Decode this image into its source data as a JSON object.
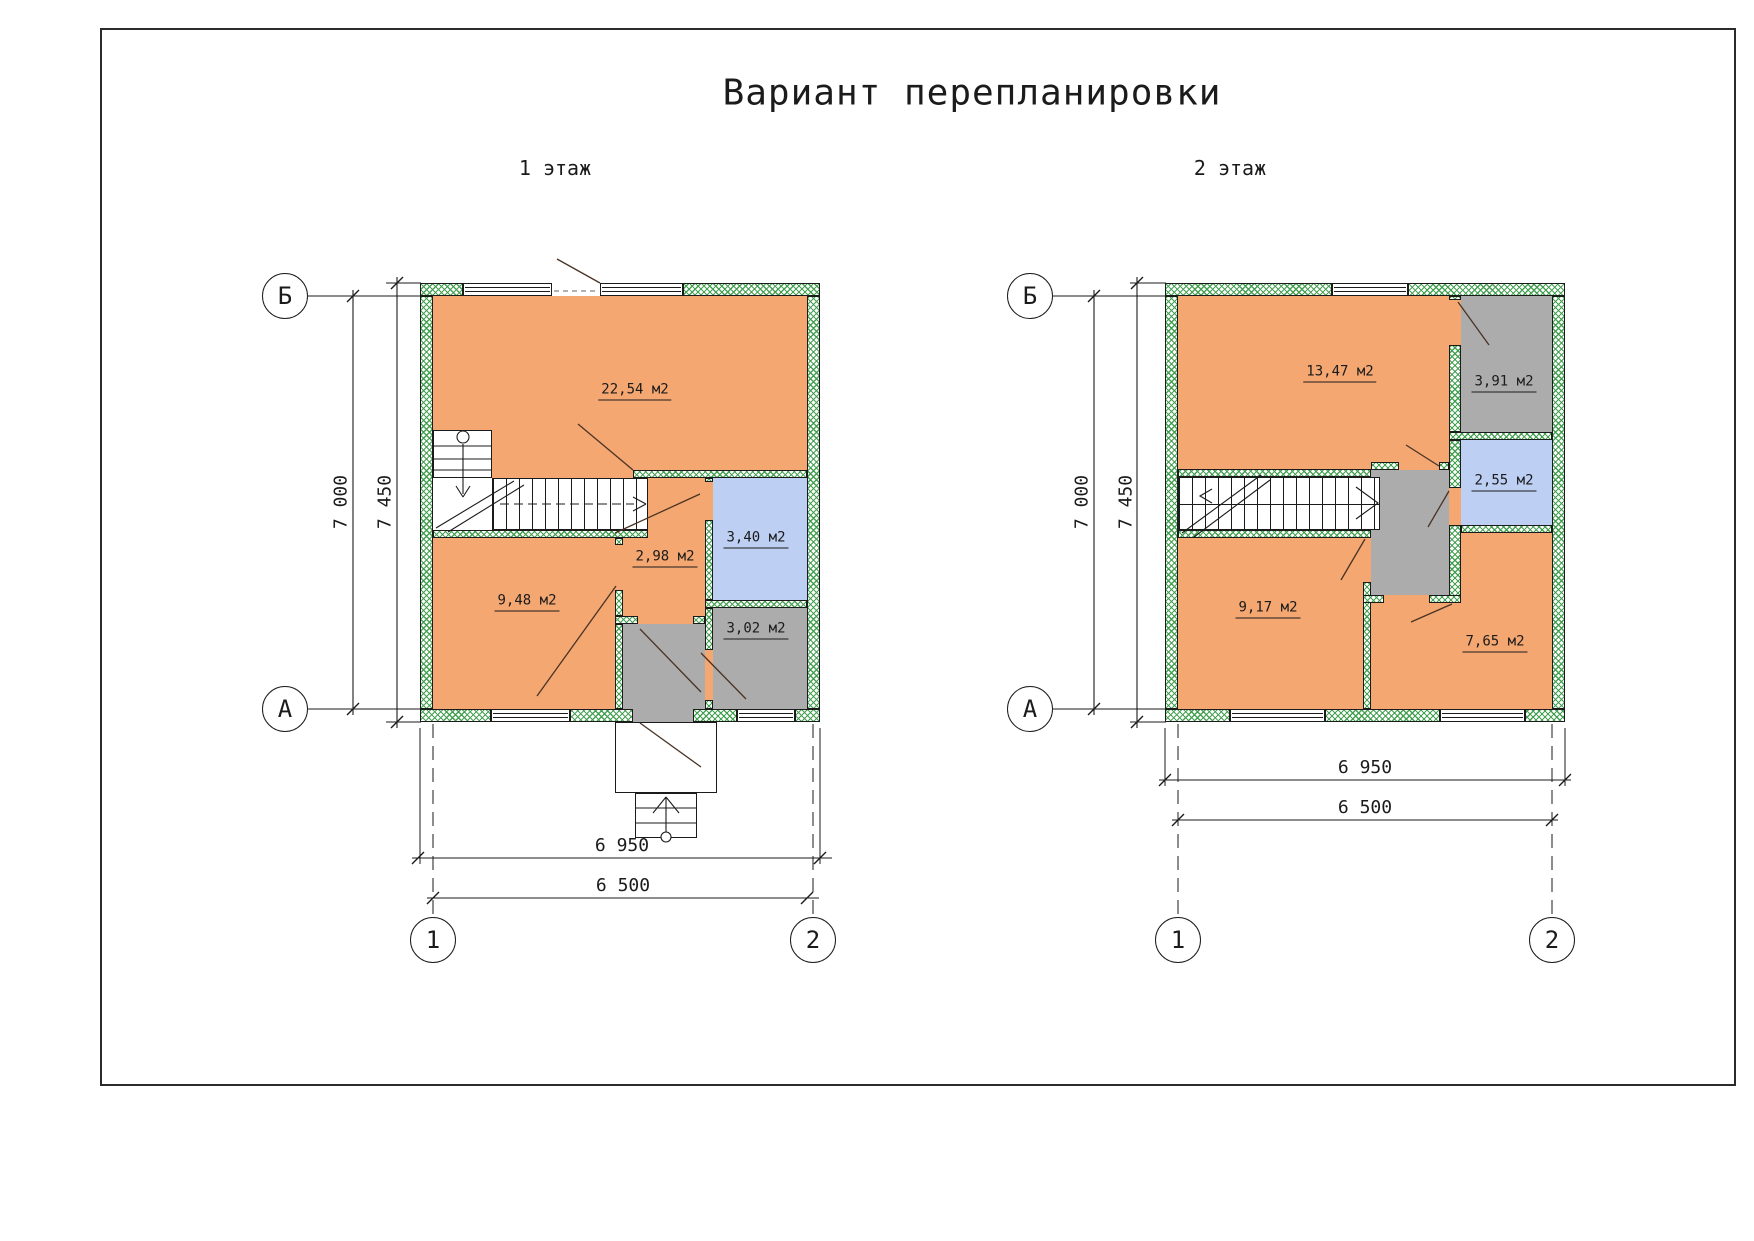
{
  "sheet": {
    "title": "Вариант перепланировки"
  },
  "floor1": {
    "label": "1 этаж",
    "rooms": [
      {
        "area": "22,54 м2",
        "fill": "#F4A771"
      },
      {
        "area": "9,48 м2",
        "fill": "#F4A771"
      },
      {
        "area": "2,98 м2",
        "fill": "#F4A771"
      },
      {
        "area": "3,40 м2",
        "fill": "#BDCFF2"
      },
      {
        "area": "3,02 м2",
        "fill": "#ACACAC"
      }
    ],
    "dims": {
      "width_total": "6 950",
      "width_axes": "6 500",
      "height_axes": "7 000",
      "height_total": "7 450"
    },
    "axes": {
      "top": "Б",
      "bottom": "А",
      "left": "1",
      "right": "2"
    }
  },
  "floor2": {
    "label": "2 этаж",
    "rooms": [
      {
        "area": "13,47 м2",
        "fill": "#F4A771"
      },
      {
        "area": "3,91 м2",
        "fill": "#ACACAC"
      },
      {
        "area": "2,55 м2",
        "fill": "#BDCFF2"
      },
      {
        "area": "9,17 м2",
        "fill": "#F4A771"
      },
      {
        "area": "7,65 м2",
        "fill": "#F4A771"
      }
    ],
    "dims": {
      "width_total": "6 950",
      "width_axes": "6 500",
      "height_axes": "7 000",
      "height_total": "7 450"
    },
    "axes": {
      "top": "Б",
      "bottom": "А",
      "left": "1",
      "right": "2"
    }
  },
  "colors": {
    "room_orange": "#F4A771",
    "room_blue": "#BDCFF2",
    "room_gray": "#ACACAC",
    "wall_hatch_green": "#3E9D4B",
    "line": "#1b1b1b"
  }
}
